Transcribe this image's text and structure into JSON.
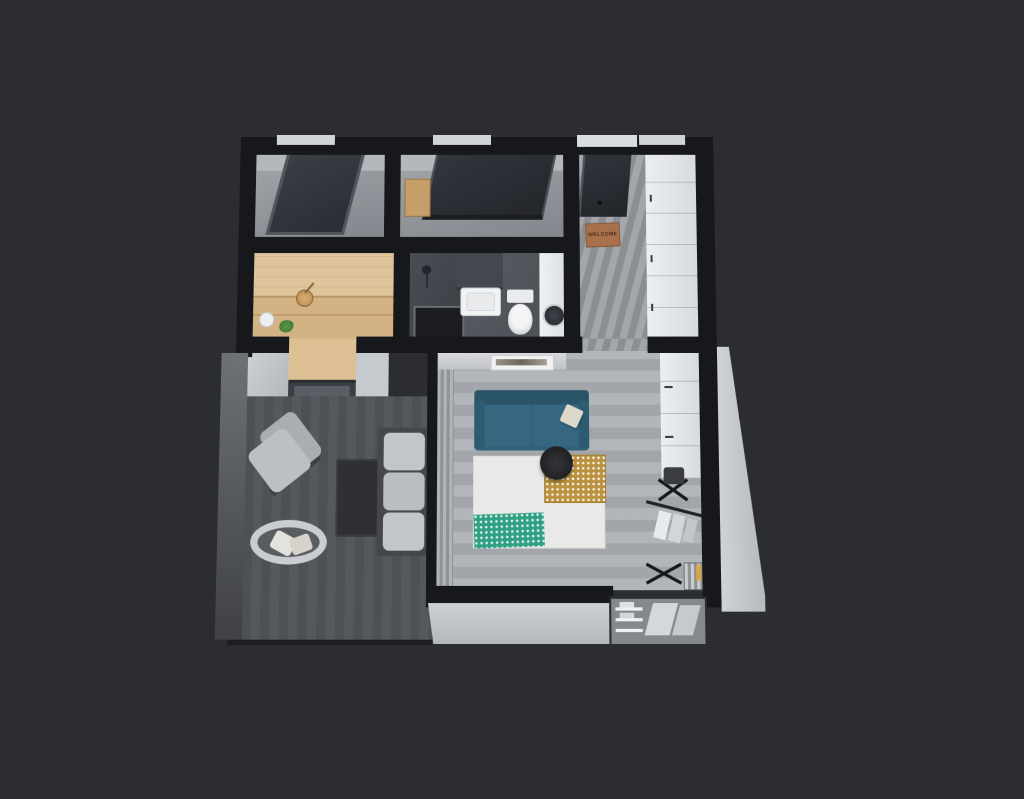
{
  "scene": {
    "description": "3D axonometric render of a one-bedroom apartment floor plan on a dark background",
    "background_color": "#2b2d32",
    "wall_cut_color": "#17181b",
    "outer_wall_face_color": "#c5c8cc"
  },
  "entry": {
    "doormat_text": "WELCOME",
    "doormat_color": "#a9714b"
  },
  "rooms": [
    {
      "name": "walk-in-closet",
      "floor": "gray concrete",
      "features": [
        "dark-glass-sliding-door"
      ]
    },
    {
      "name": "wardrobe-room",
      "floor": "gray concrete",
      "features": [
        "dark-glass-wardrobe",
        "wood-shelf"
      ]
    },
    {
      "name": "entry-hallway",
      "floor": "gray wood planks",
      "features": [
        "entrance-door",
        "welcome-doormat",
        "white-cabinet-run"
      ]
    },
    {
      "name": "sauna",
      "floor": "light pine wood",
      "features": [
        "bench",
        "wooden-bucket",
        "ladle",
        "white-bucket",
        "plant"
      ]
    },
    {
      "name": "bathroom",
      "floor": "dark gray tile",
      "features": [
        "shower-tray",
        "shower-head",
        "vanity-sink",
        "toilet",
        "washing-machine-column"
      ]
    },
    {
      "name": "living-room",
      "floor": "light gray wood",
      "features": [
        "teal-sofa",
        "white-pillow",
        "wall-art",
        "white-rug",
        "yellow-accent-rug",
        "green-patterned-throw",
        "round-black-coffee-table",
        "curtains",
        "desk-cabinets",
        "office-chair"
      ]
    },
    {
      "name": "terrace",
      "floor": "dark wood decking",
      "features": [
        "outdoor-armchair",
        "outdoor-sofa",
        "outdoor-coffee-table",
        "papasan-chair"
      ]
    },
    {
      "name": "utility-nook",
      "features": [
        "clothes-rack",
        "drying-rack",
        "slatted-heater",
        "closet-recess-with-shelves",
        "window-recess"
      ]
    }
  ],
  "palette": {
    "sofa_teal": "#31627a",
    "sauna_wood": "#e0c59c",
    "yellow_rug": "#bb923f",
    "green_throw": "#2fa084",
    "terrace_deck": "#53565b",
    "living_floor": "#abafb3",
    "bathroom_tile": "#55595f",
    "doormat": "#a9714b",
    "glass_door": "#3c3f46"
  }
}
